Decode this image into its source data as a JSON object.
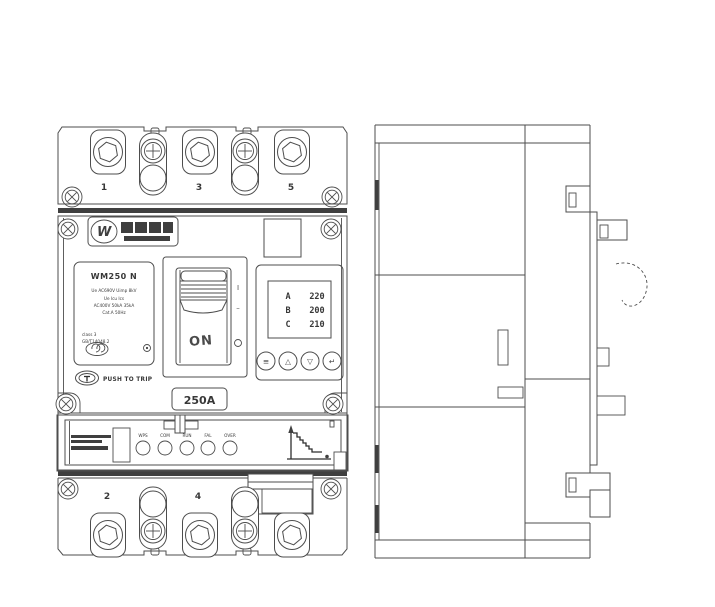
{
  "front": {
    "terminals_top": [
      "1",
      "3",
      "5"
    ],
    "terminals_bottom": [
      "2",
      "4"
    ],
    "logo_mark": "W",
    "nameplate": {
      "model": "WM250 N",
      "lines": [
        "Ue AC690V Uimp 8kV",
        "Ue Icu Ics",
        "AC400V 50kA 35kA",
        "Cat.A 50Hz",
        "class 3",
        "GB/T14048.2"
      ]
    },
    "push_to_trip": "PUSH TO TRIP",
    "switch": {
      "state": "ON",
      "marker_on": "I",
      "marker_trip": "–",
      "marker_off": "O"
    },
    "rating": "250A",
    "display": {
      "rows": [
        {
          "phase": "A",
          "value": "220"
        },
        {
          "phase": "B",
          "value": "200"
        },
        {
          "phase": "C",
          "value": "210"
        }
      ],
      "buttons": [
        {
          "name": "menu",
          "glyph": "≡"
        },
        {
          "name": "up",
          "glyph": "△"
        },
        {
          "name": "down",
          "glyph": "▽"
        },
        {
          "name": "enter",
          "glyph": "↵"
        }
      ]
    },
    "leds": [
      "WPS",
      "COM",
      "RUN",
      "FAL",
      "OVER"
    ]
  },
  "colors": {
    "line": "#4d4d4d",
    "text": "#383838",
    "bg": "#ffffff"
  }
}
